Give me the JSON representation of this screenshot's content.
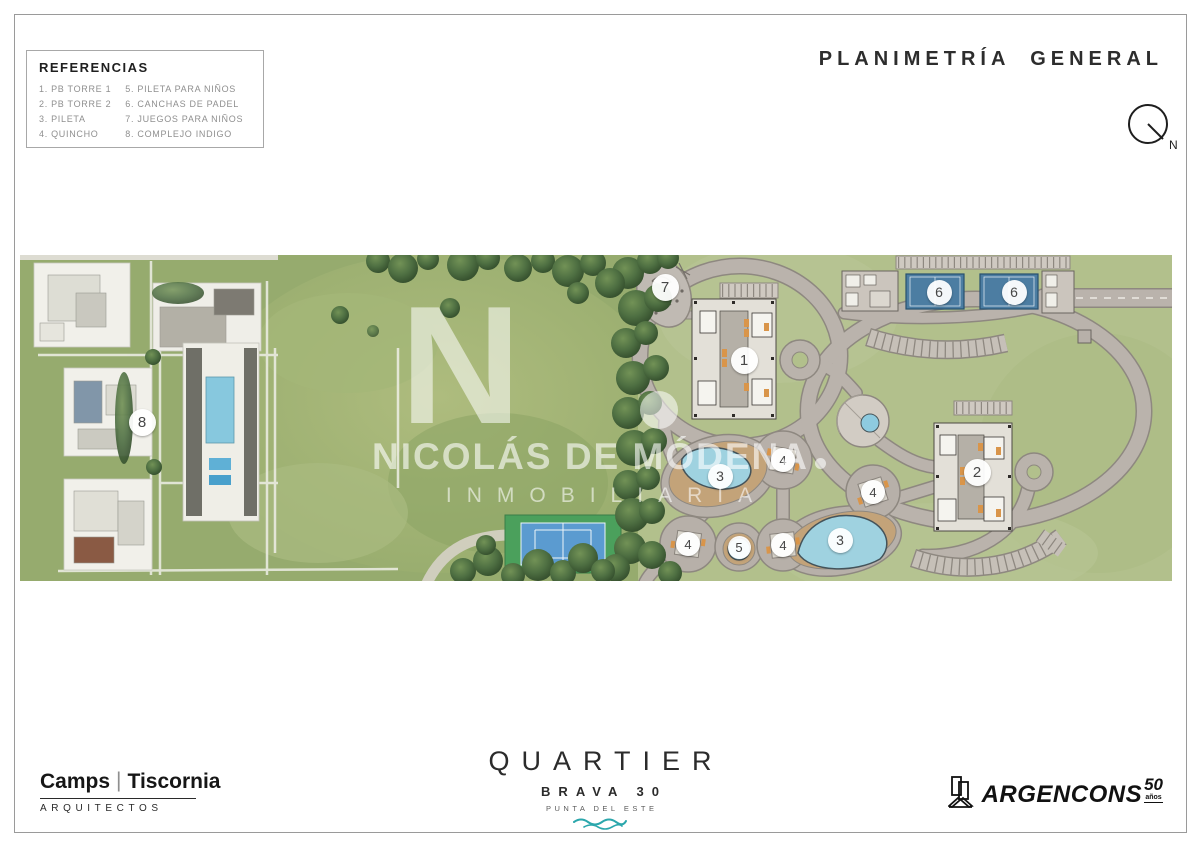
{
  "page": {
    "title": "PLANIMETRÍA GENERAL",
    "compass_label": "N"
  },
  "legend": {
    "title": "REFERENCIAS",
    "items": [
      {
        "n": "1",
        "label": "PB TORRE 1"
      },
      {
        "n": "2",
        "label": "PB TORRE 2"
      },
      {
        "n": "3",
        "label": "PILETA"
      },
      {
        "n": "4",
        "label": "QUINCHO"
      },
      {
        "n": "5",
        "label": "PILETA PARA NIÑOS"
      },
      {
        "n": "6",
        "label": "CANCHAS DE PADEL"
      },
      {
        "n": "7",
        "label": "JUEGOS PARA NIÑOS"
      },
      {
        "n": "8",
        "label": "COMPLEJO INDIGO"
      }
    ]
  },
  "watermark": {
    "monogram": "N",
    "name": "NICOLÁS DE MÓDENA",
    "subtitle": "INMOBILIARIA"
  },
  "plan": {
    "markers": [
      {
        "n": "8",
        "x": 124,
        "y": 169,
        "size": 27
      },
      {
        "n": "7",
        "x": 647,
        "y": 34,
        "size": 27
      },
      {
        "n": "1",
        "x": 726,
        "y": 107,
        "size": 27
      },
      {
        "n": "6",
        "x": 921,
        "y": 39,
        "size": 25
      },
      {
        "n": "6",
        "x": 996,
        "y": 39,
        "size": 25
      },
      {
        "n": "4",
        "x": 765,
        "y": 207,
        "size": 24
      },
      {
        "n": "3",
        "x": 702,
        "y": 223,
        "size": 25
      },
      {
        "n": "4",
        "x": 855,
        "y": 239,
        "size": 24
      },
      {
        "n": "2",
        "x": 959,
        "y": 219,
        "size": 27
      },
      {
        "n": "4",
        "x": 670,
        "y": 291,
        "size": 24
      },
      {
        "n": "5",
        "x": 721,
        "y": 294,
        "size": 23
      },
      {
        "n": "4",
        "x": 765,
        "y": 292,
        "size": 24
      },
      {
        "n": "3",
        "x": 822,
        "y": 287,
        "size": 25
      }
    ]
  },
  "footer": {
    "architects": {
      "name_left": "Camps",
      "separator": "|",
      "name_right": "Tiscornia",
      "subtitle": "ARQUITECTOS"
    },
    "brand": {
      "name": "QUARTIER",
      "line2": "BRAVA 30",
      "line3": "PUNTA DEL ESTE"
    },
    "developer": {
      "name": "ARGENCONS",
      "anniversary_number": "50",
      "anniversary_label": "años"
    }
  },
  "colors": {
    "grass_aerial": "#9fb173",
    "grass_plan": "#b2c08c",
    "road": "#bab3ac",
    "road_casing": "#8e8880",
    "padel_blue": "#4c7da2",
    "pool_blue": "#9fd2e0",
    "deck_tan": "#c3a379",
    "wave_teal": "#2ba7ac",
    "text_dark": "#2d2d2d",
    "legend_gray": "#8f8f8f"
  }
}
